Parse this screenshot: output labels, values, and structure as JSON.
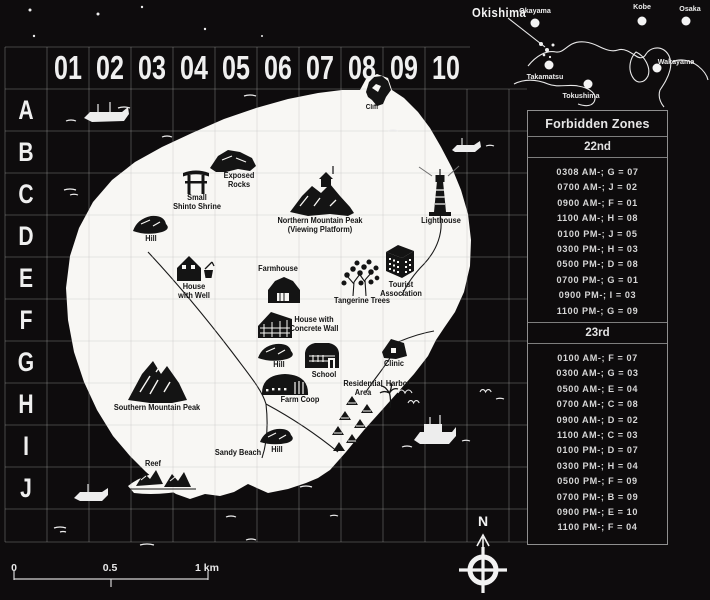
{
  "grid": {
    "columns": [
      "01",
      "02",
      "03",
      "04",
      "05",
      "06",
      "07",
      "08",
      "09",
      "10"
    ],
    "rows": [
      "A",
      "B",
      "C",
      "D",
      "E",
      "F",
      "G",
      "H",
      "I",
      "J"
    ]
  },
  "island": {
    "locations": [
      {
        "id": "cliff",
        "label": "Cliff"
      },
      {
        "id": "exposed-rocks",
        "label": "Exposed\nRocks"
      },
      {
        "id": "small-shinto-shrine",
        "label": "Small\nShinto Shrine"
      },
      {
        "id": "northern-mountain-peak",
        "label": "Northern Mountain Peak\n(Viewing Platform)"
      },
      {
        "id": "lighthouse",
        "label": "Lighthouse"
      },
      {
        "id": "hill-north",
        "label": "Hill"
      },
      {
        "id": "house-with-well",
        "label": "House\nwith Well"
      },
      {
        "id": "farmhouse",
        "label": "Farmhouse"
      },
      {
        "id": "tangerine-trees",
        "label": "Tangerine Trees"
      },
      {
        "id": "tourist-association",
        "label": "Tourist\nAssociation"
      },
      {
        "id": "house-with-concrete-wall",
        "label": "House with\nConcrete Wall"
      },
      {
        "id": "hill-central",
        "label": "Hill"
      },
      {
        "id": "school",
        "label": "School"
      },
      {
        "id": "clinic",
        "label": "Clinic"
      },
      {
        "id": "farm-coop",
        "label": "Farm Coop"
      },
      {
        "id": "residential-area",
        "label": "Residential\nArea"
      },
      {
        "id": "harbor",
        "label": "Harbor"
      },
      {
        "id": "southern-mountain-peak",
        "label": "Southern Mountain Peak"
      },
      {
        "id": "sandy-beach",
        "label": "Sandy Beach"
      },
      {
        "id": "hill-south",
        "label": "Hill"
      },
      {
        "id": "reef",
        "label": "Reef"
      }
    ]
  },
  "minimap": {
    "okishima": "Okishima",
    "cities": [
      "Okayama",
      "Kobe",
      "Osaka",
      "Wakayama",
      "Takamatsu",
      "Tokushima"
    ]
  },
  "forbidden_zones": {
    "title": "Forbidden Zones",
    "days": [
      {
        "label": "22nd",
        "entries": [
          "0308 AM-; G = 07",
          "0700 AM-; J = 02",
          "0900 AM-; F = 01",
          "1100 AM-; H = 08",
          "0100 PM-; J = 05",
          "0300 PM-; H = 03",
          "0500 PM-; D = 08",
          "0700 PM-; G = 01",
          "0900 PM-; I = 03",
          "1100 PM-; G = 09"
        ]
      },
      {
        "label": "23rd",
        "entries": [
          "0100 AM-; F = 07",
          "0300 AM-; G = 03",
          "0500 AM-; E = 04",
          "0700 AM-; C = 08",
          "0900 AM-; D = 02",
          "1100 AM-; C = 03",
          "0100 PM-; D = 07",
          "0300 PM-; H = 04",
          "0500 PM-; F = 09",
          "0700 PM-; B = 09",
          "0900 PM-; E = 10",
          "1100 PM-; F = 04"
        ]
      }
    ]
  },
  "scale_bar": {
    "start": "0",
    "middle": "0.5",
    "end": "1 km"
  },
  "compass": {
    "north": "N"
  },
  "colors": {
    "background": "#0e0c0d",
    "island": "#f8f7f4",
    "ink": "#141414",
    "grid_line": "#bdbdbd",
    "text": "#e8e8e8"
  }
}
